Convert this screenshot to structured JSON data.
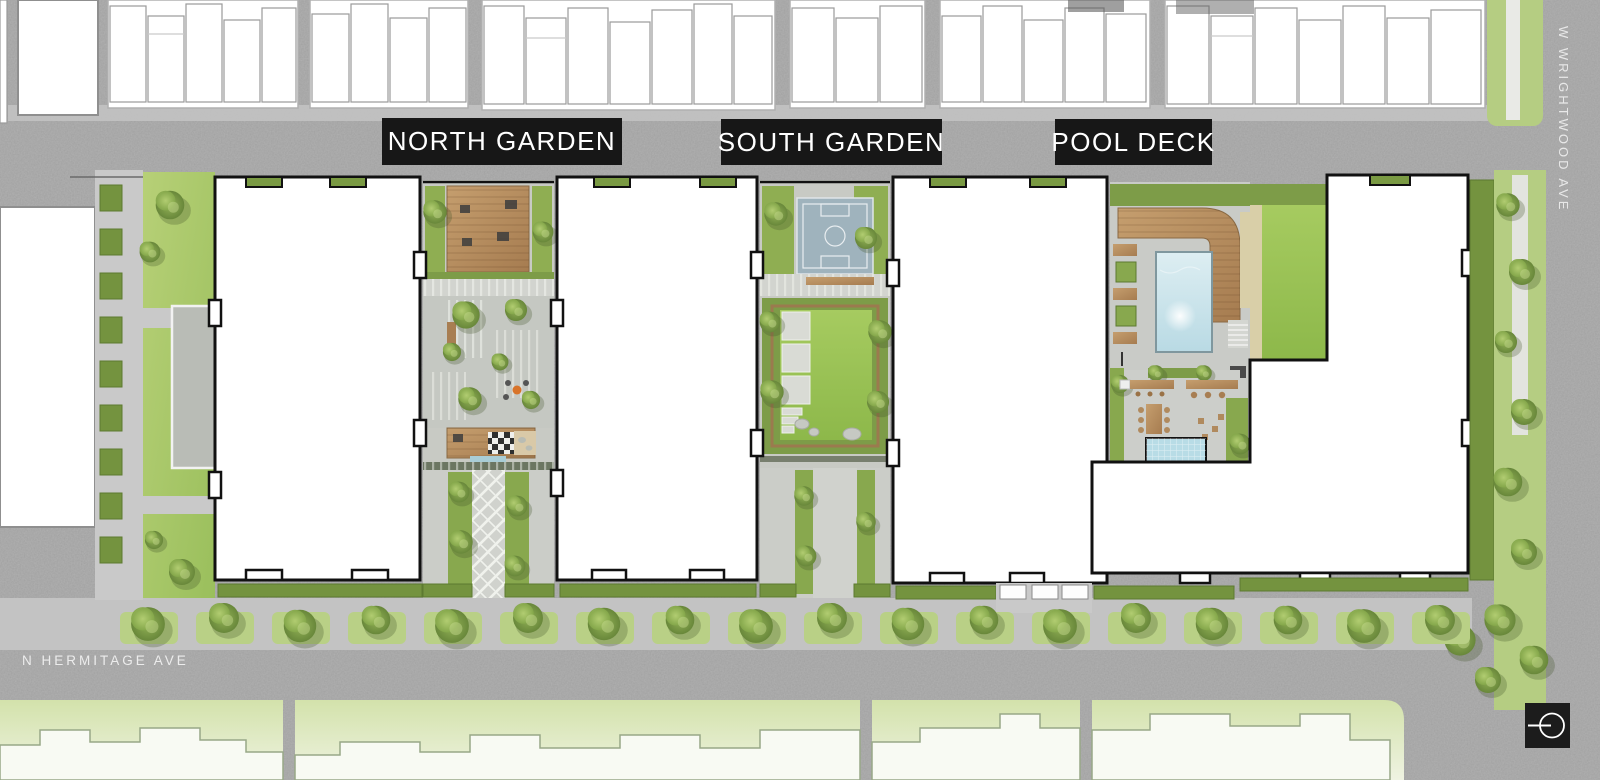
{
  "map": {
    "title": "residential development site plan",
    "area_labels": [
      {
        "id": "north-garden",
        "text": "NORTH GARDEN"
      },
      {
        "id": "south-garden",
        "text": "SOUTH GARDEN"
      },
      {
        "id": "pool-deck",
        "text": "POOL DECK"
      }
    ],
    "street_labels": [
      {
        "id": "hermitage",
        "text": "N HERMITAGE AVE",
        "orientation": "horizontal"
      },
      {
        "id": "wrightwood",
        "text": "W WRIGHTWOOD AVE",
        "orientation": "vertical"
      }
    ],
    "compass": {
      "icon": "north-arrow-compass-icon"
    },
    "features": [
      "townhouse footprints",
      "main residential buildings",
      "north garden courtyard",
      "south garden courtyard with sport court and lawn",
      "pool deck with pool and spa",
      "street trees and parkway planters"
    ],
    "palette": {
      "asphalt": "#a3a3a3",
      "sidewalk": "#c6c6c6",
      "building_fill": "#ffffff",
      "building_outline": "#111111",
      "label_bg": "#171717",
      "label_text": "#ffffff",
      "lawn": "#9cc353",
      "hedge": "#74933f",
      "tree_canopy": "#86a94c",
      "wood_deck": "#b88f63",
      "pool_water": "#cfe6ec",
      "sport_court": "#9fb3bd",
      "pale_building": "#f8faf3"
    }
  }
}
